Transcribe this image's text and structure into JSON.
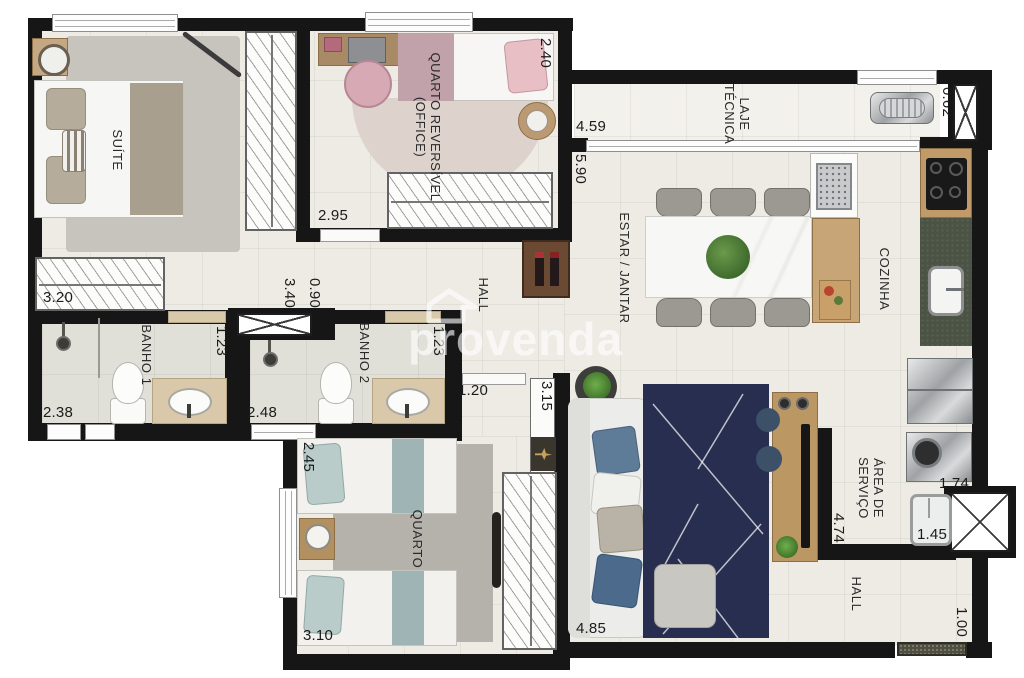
{
  "watermark": {
    "text": "provenda"
  },
  "rooms": {
    "suite": "SUÍTE",
    "quarto_reversivel_l1": "QUARTO REVERSÍVEL",
    "quarto_reversivel_l2": "(OFFICE)",
    "laje_l1": "LAJE",
    "laje_l2": "TÉCNICA",
    "estar_jantar": "ESTAR / JANTAR",
    "cozinha": "COZINHA",
    "hall_central": "HALL",
    "banho1": "BANHO 1",
    "banho2": "BANHO 2",
    "quarto": "QUARTO",
    "area_servico_l1": "ÁREA DE",
    "area_servico_l2": "SERVIÇO",
    "hall_entrada": "HALL"
  },
  "dims": {
    "suite_w": "3.20",
    "suite_d": "3.40",
    "hall_pass": "0.90",
    "qr_w": "2.95",
    "qr_d": "2.40",
    "laje_l": "4.59",
    "laje_w": "0.62",
    "estar_d": "5.90",
    "estar_w": "4.85",
    "banho1_w": "2.38",
    "banho1_d": "1.23",
    "banho2_w": "2.48",
    "banho2_d": "1.23",
    "corredor_w": "1.20",
    "armario_l": "3.15",
    "quarto_d": "2.45",
    "quarto_w": "3.10",
    "servico_d": "4.74",
    "servico_w": "1.74",
    "tanque_w": "1.45",
    "hall_w": "1.00"
  },
  "colors": {
    "wall": "#161616",
    "floor": "#edebe4",
    "navy_rug": "#272e4f",
    "counter_green": "#4b5345",
    "wood": "#b3905f"
  }
}
